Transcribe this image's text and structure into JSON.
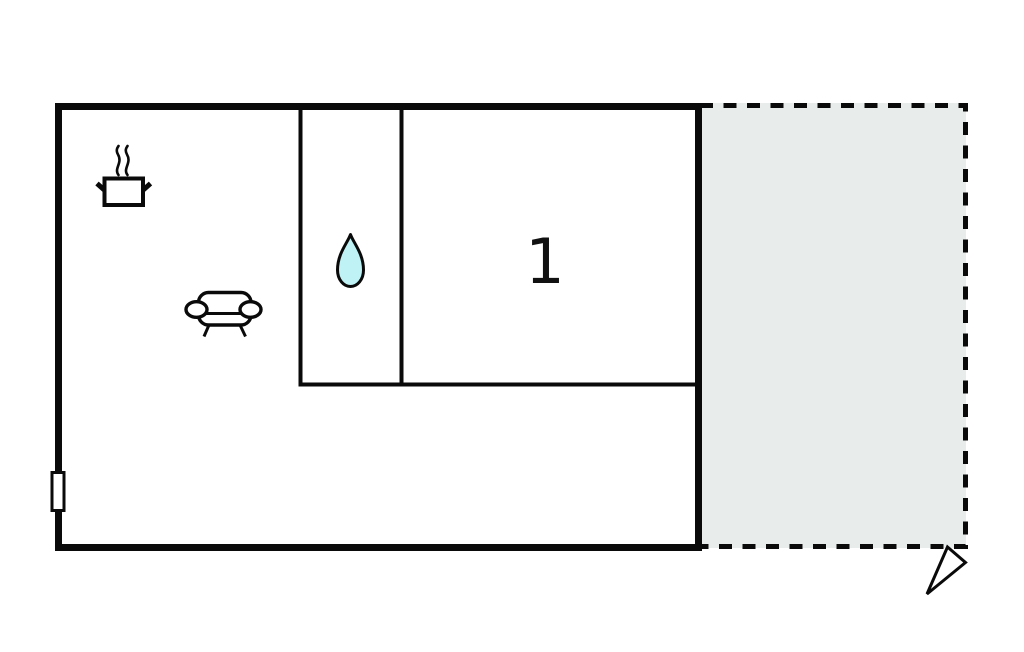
{
  "floorplan": {
    "bedroom": {
      "label": "1"
    },
    "colors": {
      "wall": "#0a0a0a",
      "terrace_fill": "#e8edec",
      "water_drop_fill": "#bff2f5",
      "background": "#ffffff"
    },
    "icons": {
      "kitchen": "cooking-pot-icon",
      "living_room": "sofa-icon",
      "bathroom": "water-drop-icon",
      "direction": "entrance-arrow-icon"
    }
  }
}
